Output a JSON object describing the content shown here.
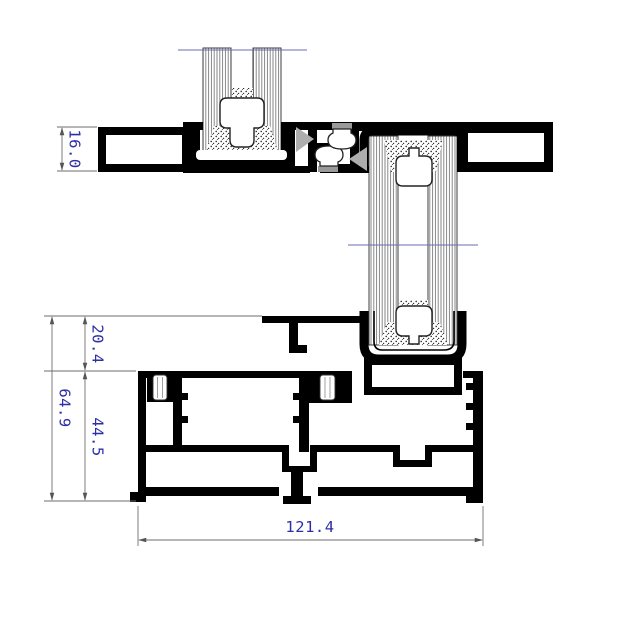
{
  "drawing": {
    "kind": "aluminium sliding window CAD section",
    "dims": {
      "head_frame_height": "16.0",
      "sill_upper_height": "20.4",
      "sill_lower_height": "44.5",
      "sill_total_height": "64.9",
      "sill_total_width": "121.4"
    },
    "colors": {
      "profile": "#000000",
      "gasket_gray": "#adadad",
      "dim_line": "#6e6e6e",
      "dim_text": "#2e2ea6",
      "break_line": "#6b6bb4"
    }
  }
}
